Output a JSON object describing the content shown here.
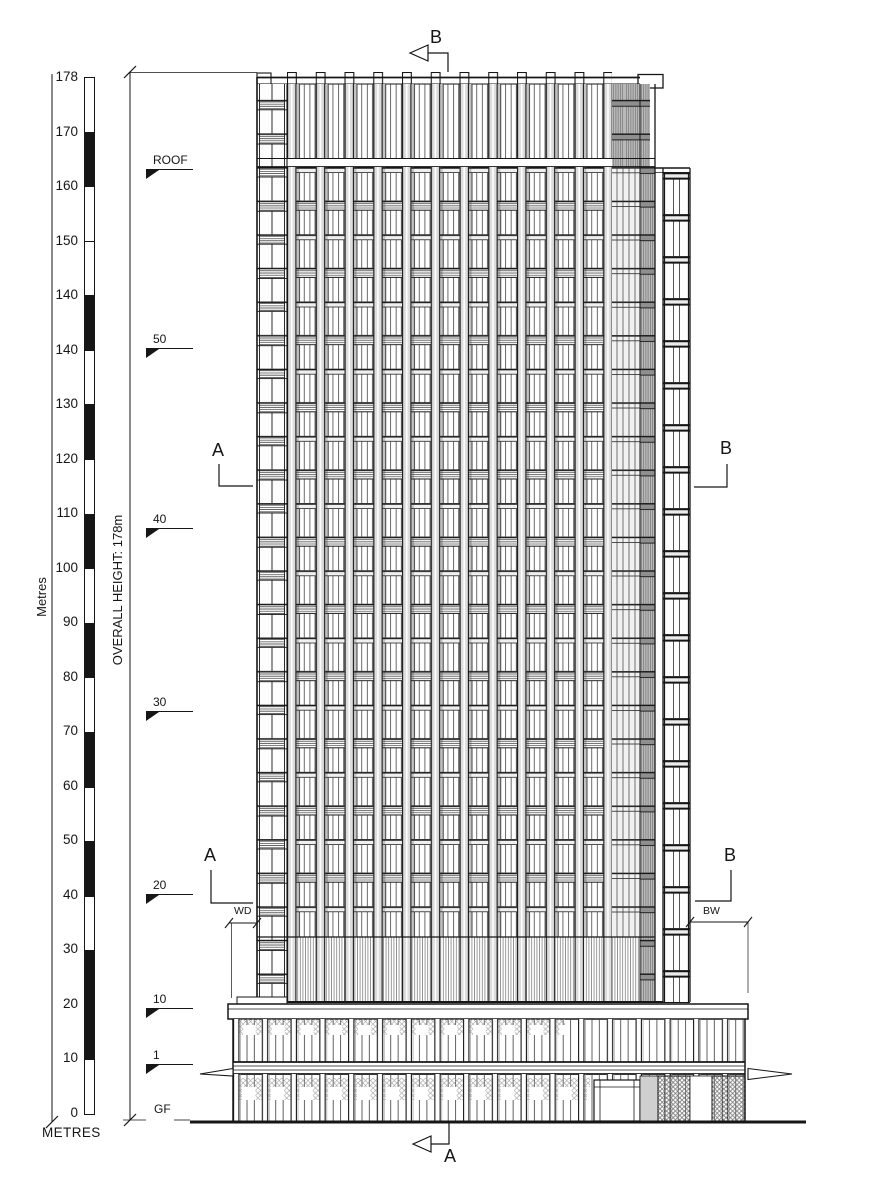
{
  "drawing": {
    "kind": "building elevation",
    "line_color": "#161616",
    "background": "#ffffff"
  },
  "scale_bar": {
    "unit_side": "Metres",
    "unit_bottom": "METRES",
    "tick_labels": [
      "178",
      "170",
      "160",
      "150",
      "140",
      "140",
      "130",
      "120",
      "110",
      "100",
      "90",
      "80",
      "70",
      "60",
      "50",
      "40",
      "30",
      "20",
      "10",
      "0"
    ],
    "segments": [
      "w",
      "b",
      "w",
      "w",
      "b",
      "w",
      "b",
      "w",
      "b",
      "w",
      "b",
      "w",
      "b",
      "w",
      "b",
      "w",
      "b",
      "b",
      "w"
    ]
  },
  "overall_height_label": "OVERALL HEIGHT: 178m",
  "levels": [
    {
      "label": "ROOF"
    },
    {
      "label": "50"
    },
    {
      "label": "40"
    },
    {
      "label": "30"
    },
    {
      "label": "20"
    },
    {
      "label": "10"
    },
    {
      "label": "1"
    },
    {
      "label": "GF"
    }
  ],
  "section_markers": {
    "top": "B",
    "bottom": "A",
    "upper_left": "A",
    "upper_right": "B",
    "lower_left": "A",
    "lower_right": "B"
  },
  "width_dims": {
    "left": "WD",
    "right": "BW"
  }
}
